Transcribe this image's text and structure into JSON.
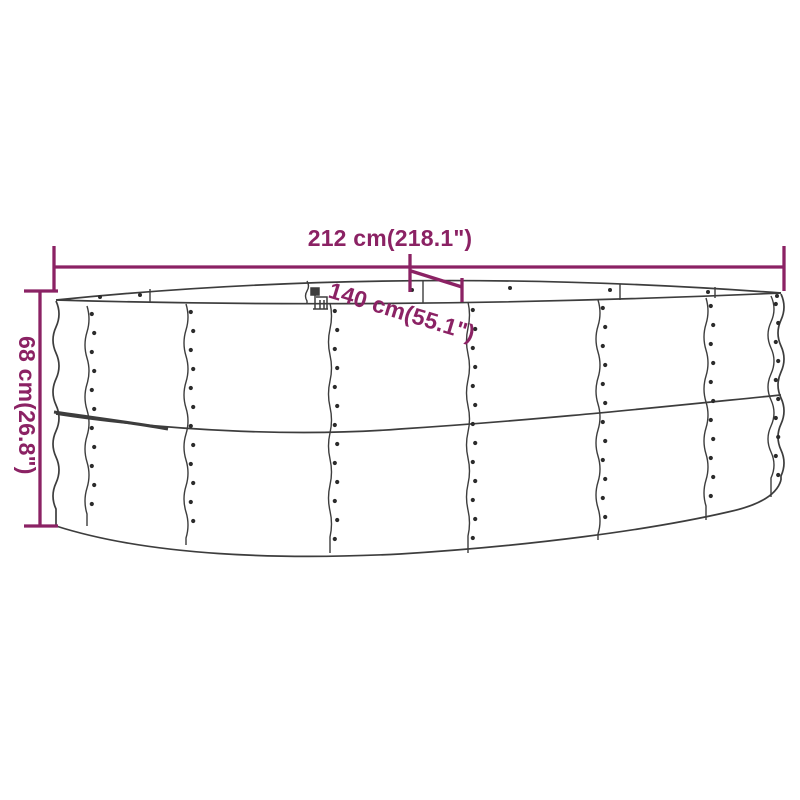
{
  "diagram": {
    "subject": "raised-garden-bed-outline-drawing",
    "dimensions": {
      "length_label": "212 cm(218.1\")",
      "width_label": "140 cm(55.1\")",
      "height_label": "68 cm(26.8\")",
      "length_cm": 212,
      "length_in": 218.1,
      "width_cm": 140,
      "width_in": 55.1,
      "height_cm": 68,
      "height_in": 26.8
    }
  },
  "colors": {
    "dimension_accent": "#8B2264",
    "line_color": "#3D3D3D",
    "rivet_color": "#2B2B2B",
    "background": "#FFFFFF"
  }
}
